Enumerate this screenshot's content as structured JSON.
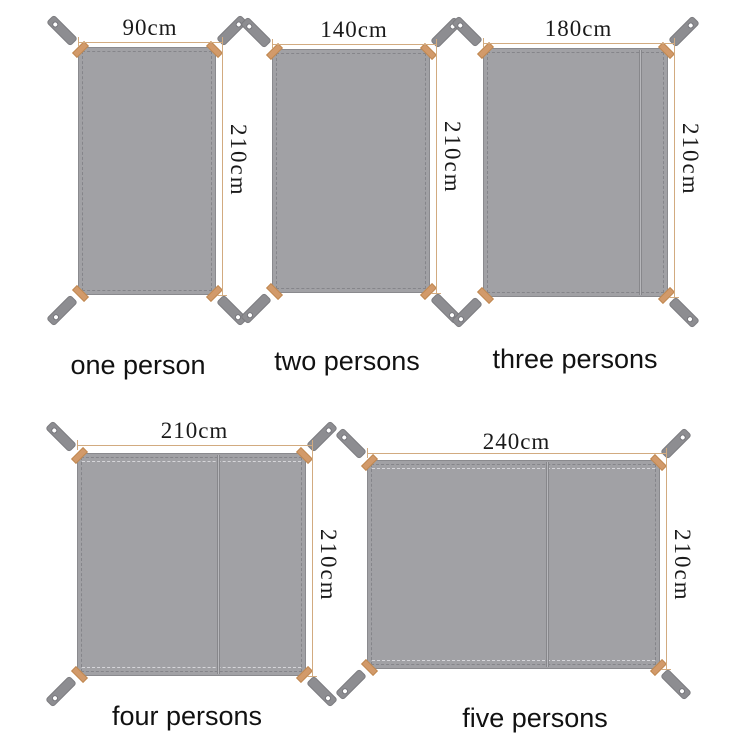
{
  "tarps": [
    {
      "capacity_label": "one person",
      "width_label": "90cm",
      "height_label": "210cm",
      "width_cm": 90,
      "height_cm": 210
    },
    {
      "capacity_label": "two persons",
      "width_label": "140cm",
      "height_label": "210cm",
      "width_cm": 140,
      "height_cm": 210
    },
    {
      "capacity_label": "three persons",
      "width_label": "180cm",
      "height_label": "210cm",
      "width_cm": 180,
      "height_cm": 210
    },
    {
      "capacity_label": "four persons",
      "width_label": "210cm",
      "height_label": "210cm",
      "width_cm": 210,
      "height_cm": 210
    },
    {
      "capacity_label": "five persons",
      "width_label": "240cm",
      "height_label": "210cm",
      "width_cm": 240,
      "height_cm": 210
    }
  ],
  "colors": {
    "fabric": "#a1a1a5",
    "fabric_border": "#8a8a8e",
    "stitching": "#85858a",
    "strap": "#8d8d91",
    "strap_hole": "#ffffff",
    "corner_reinforcement": "#d29a6a",
    "dimension_line": "#d2ab80",
    "label_text": "#1a1a1a"
  }
}
